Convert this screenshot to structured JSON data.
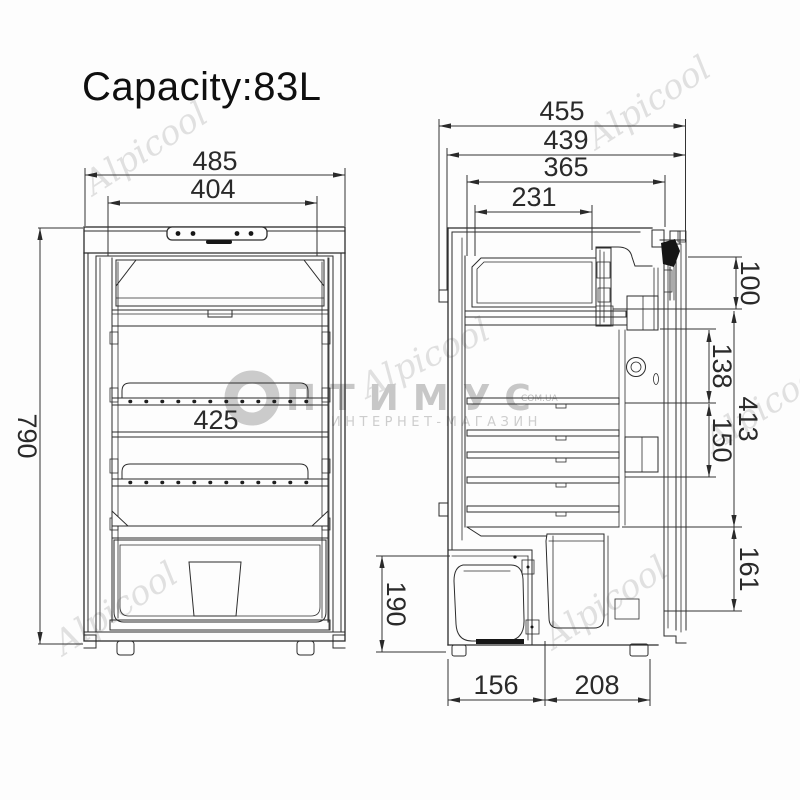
{
  "title": "Capacity:83L",
  "front_view": {
    "label": "front view",
    "dims": {
      "outer_width": "485",
      "door_inner_width": "404",
      "shelf_width": "425",
      "height": "790"
    }
  },
  "side_view": {
    "label": "side cross-section view",
    "dims": {
      "depth_overall": "455",
      "depth_body": "439",
      "depth_interior": "365",
      "freezer_depth": "231",
      "top_to_first_shelf": "100",
      "upper_shelf_gap": "138",
      "interior_height": "413",
      "lower_shelf_gap": "150",
      "bottom_front_height": "161",
      "compressor_compartment_height": "190",
      "compressor_compartment_depth": "156",
      "front_floor_depth": "208"
    }
  },
  "watermarks": {
    "brand_script": "Alpicool",
    "store_logo_text": "ПТИМУС",
    "store_domain": "COM.UA",
    "store_tagline": "ИНТЕРНЕТ-МАГАЗИН"
  }
}
